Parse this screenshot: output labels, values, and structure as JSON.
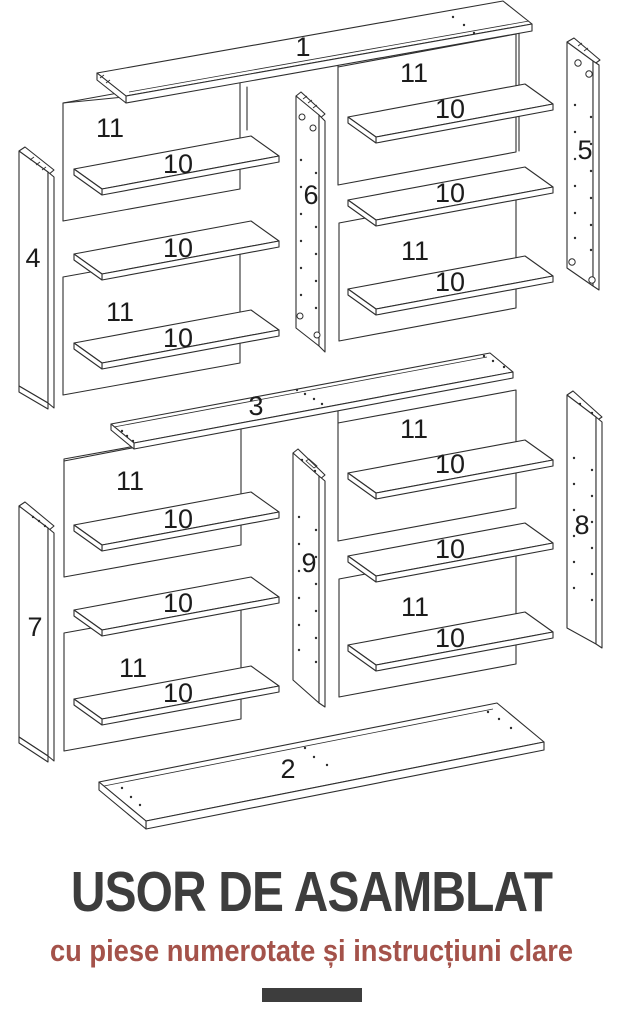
{
  "diagram": {
    "stroke_color": "#2e2e2e",
    "label_color": "#1c1c1c",
    "description": "Exploded isometric assembly diagram of a two-tier shelving unit with numbered parts",
    "part_numbers": [
      "1",
      "2",
      "3",
      "4",
      "5",
      "6",
      "7",
      "8",
      "9",
      "10",
      "11"
    ],
    "labels": [
      {
        "text": "1",
        "x": 303,
        "y": 56
      },
      {
        "text": "11",
        "x": 110,
        "y": 137
      },
      {
        "text": "10",
        "x": 178,
        "y": 173
      },
      {
        "text": "10",
        "x": 178,
        "y": 257
      },
      {
        "text": "11",
        "x": 120,
        "y": 321
      },
      {
        "text": "10",
        "x": 178,
        "y": 347
      },
      {
        "text": "11",
        "x": 414,
        "y": 82
      },
      {
        "text": "10",
        "x": 450,
        "y": 118
      },
      {
        "text": "10",
        "x": 450,
        "y": 202
      },
      {
        "text": "11",
        "x": 415,
        "y": 260
      },
      {
        "text": "10",
        "x": 450,
        "y": 291
      },
      {
        "text": "4",
        "x": 33,
        "y": 267
      },
      {
        "text": "6",
        "x": 311,
        "y": 204
      },
      {
        "text": "5",
        "x": 585,
        "y": 159
      },
      {
        "text": "3",
        "x": 256,
        "y": 415
      },
      {
        "text": "11",
        "x": 130,
        "y": 490
      },
      {
        "text": "10",
        "x": 178,
        "y": 528
      },
      {
        "text": "10",
        "x": 178,
        "y": 612
      },
      {
        "text": "11",
        "x": 133,
        "y": 677
      },
      {
        "text": "10",
        "x": 178,
        "y": 702
      },
      {
        "text": "11",
        "x": 414,
        "y": 438
      },
      {
        "text": "10",
        "x": 450,
        "y": 473
      },
      {
        "text": "10",
        "x": 450,
        "y": 558
      },
      {
        "text": "11",
        "x": 415,
        "y": 616
      },
      {
        "text": "10",
        "x": 450,
        "y": 647
      },
      {
        "text": "7",
        "x": 35,
        "y": 636
      },
      {
        "text": "9",
        "x": 309,
        "y": 572
      },
      {
        "text": "8",
        "x": 582,
        "y": 534
      },
      {
        "text": "2",
        "x": 288,
        "y": 778
      }
    ]
  },
  "footer": {
    "title": "USOR DE ASAMBLAT",
    "subtitle": "cu piese numerotate și instrucțiuni clare",
    "title_color": "#3d3d3d",
    "subtitle_color": "#a4524a",
    "bar_color": "#3d3d3d"
  }
}
